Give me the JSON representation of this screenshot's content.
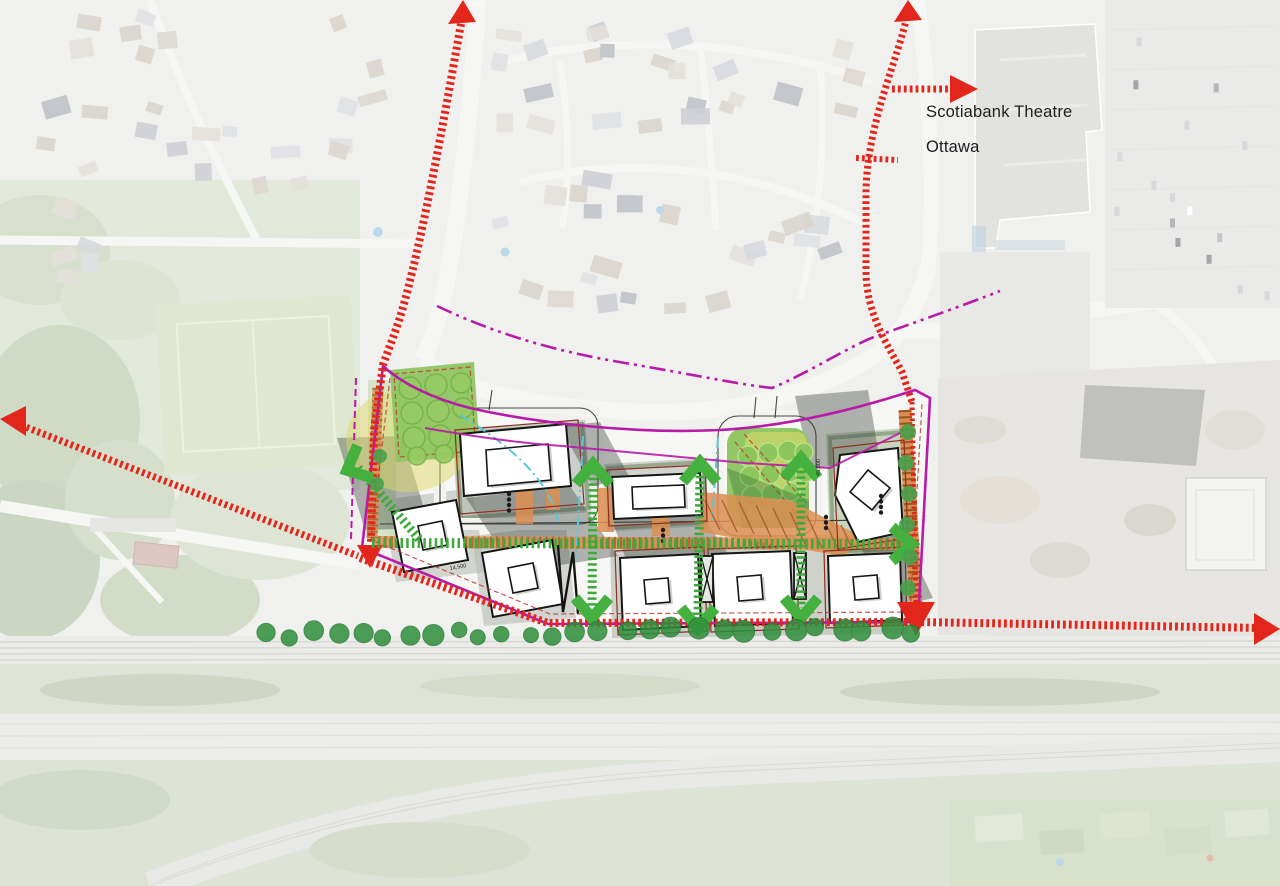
{
  "labels": {
    "theatre_line1": "Scotiabank Theatre",
    "theatre_line2": "Ottawa"
  },
  "dimensions": {
    "d1": "14,500",
    "d2": "45,000"
  },
  "colors": {
    "route_red": "#e2261b",
    "boundary_magenta": "#b81ba8",
    "path_green": "#3faa3c",
    "arrow_green": "#44b13f",
    "plaza_orange": "#dd8f52",
    "plaza_hatch": "#9a5a28",
    "park_green": "#8cc45e",
    "park_yellow": "#ddd968",
    "tree_dark_green": "#2f8f3c",
    "utility_cyan": "#5ac6d8",
    "building_fill": "#ffffff",
    "building_outline": "#151515",
    "podium_red": "#8c2f1f",
    "shadow_gray": "#39403a",
    "label_text": "#1d1d1d"
  }
}
